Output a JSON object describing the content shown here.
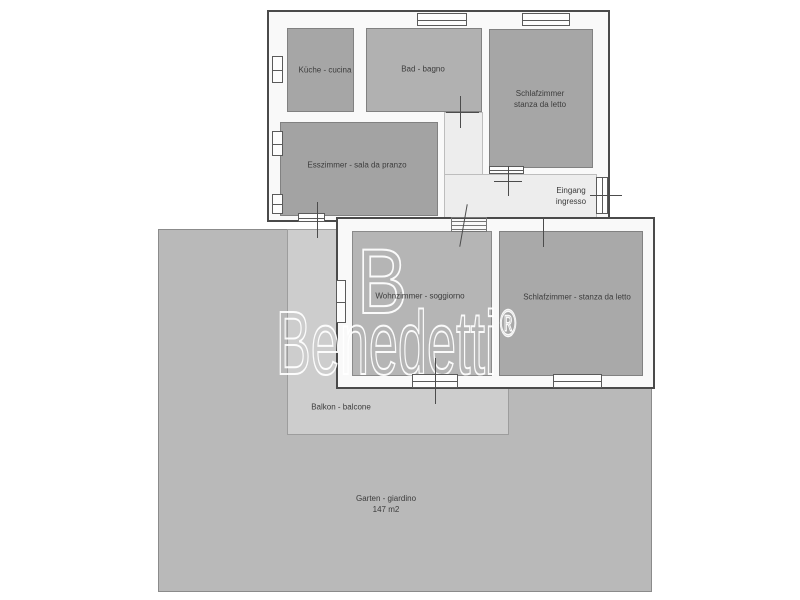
{
  "title": "Floor plan",
  "rooms": {
    "kueche": {
      "label": "Küche - cucina"
    },
    "bad": {
      "label": "Bad - bagno"
    },
    "schlafzimmer1": {
      "line1": "Schlafzimmer",
      "line2": "stanza da letto"
    },
    "esszimmer": {
      "label": "Esszimmer - sala da pranzo"
    },
    "eingang": {
      "line1": "Eingang",
      "line2": "ingresso"
    },
    "wohnzimmer": {
      "label": "Wohnzimmer - soggiorno"
    },
    "schlafzimmer2": {
      "label": "Schlafzimmer - stanza da letto"
    },
    "balkon": {
      "label": "Balkon - balcone"
    },
    "garten": {
      "line1": "Garten - giardino",
      "line2": "147 m2"
    }
  },
  "watermark": {
    "brand": "Benedetti",
    "registered": "®",
    "logo_letter": "B"
  },
  "colors": {
    "garden": "#b9b9b9",
    "balcony": "#cdcdcd",
    "room_dark_gray": "#a6a6a6",
    "room_mid_gray": "#b1b1b1",
    "room_living": "#b5b5b5",
    "hallway": "#ededed",
    "wall_outline": "#4a4a4a",
    "label_text": "#3c3c3c",
    "watermark": "#ffffff",
    "background": "#ffffff"
  }
}
